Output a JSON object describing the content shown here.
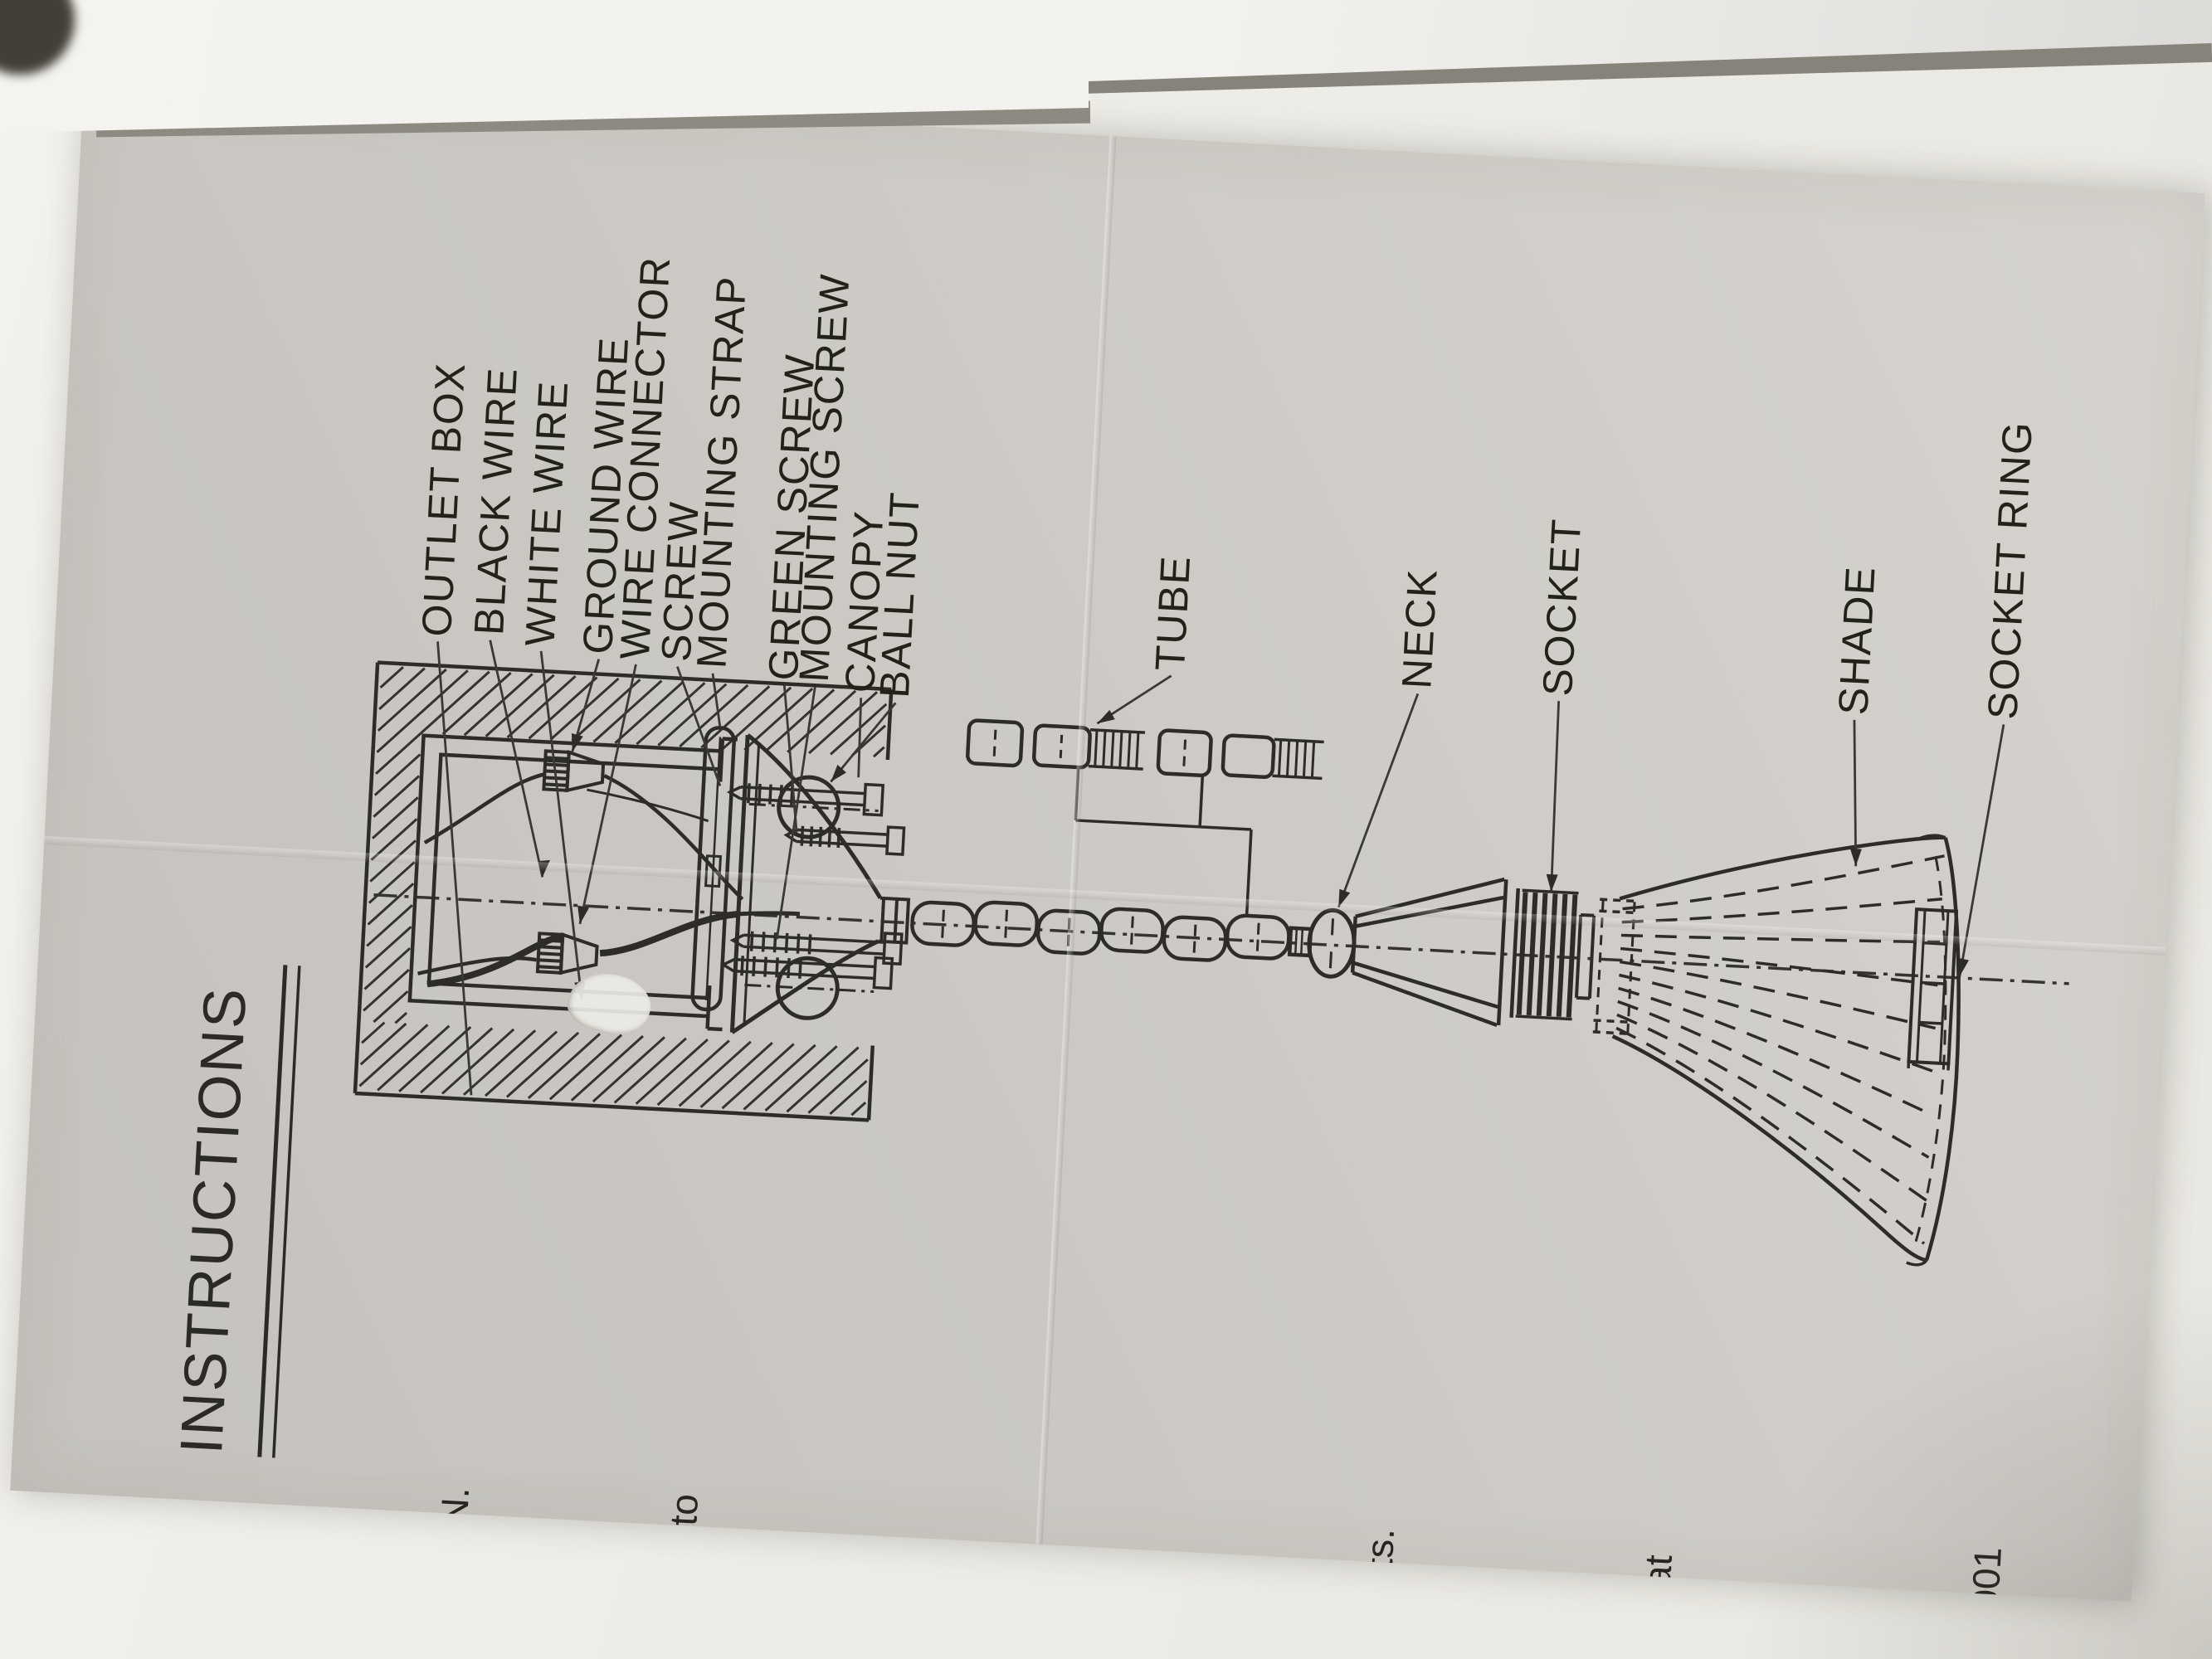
{
  "photo": {
    "table_color": "#f0eee9",
    "fold_shadow_color": "#8b897f",
    "paper_color": "#cbc8c3",
    "ink_color": "#2d2c27"
  },
  "sheet": {
    "title": "INSTRUCTIONS",
    "part_labels": [
      "OUTLET BOX",
      "BLACK WIRE",
      "WHITE WIRE",
      "GROUND WIRE",
      "WIRE CONNECTOR",
      "SCREW",
      "MOUNTING STRAP",
      "GREEN SCREW",
      "MOUNTING SCREW",
      "CANOPY",
      "BALL NUT",
      "TUBE",
      "NECK",
      "SOCKET",
      "SHADE",
      "SOCKET RING"
    ],
    "edge_fragments": [
      "N.",
      "to",
      "its.",
      "at",
      "001"
    ]
  }
}
